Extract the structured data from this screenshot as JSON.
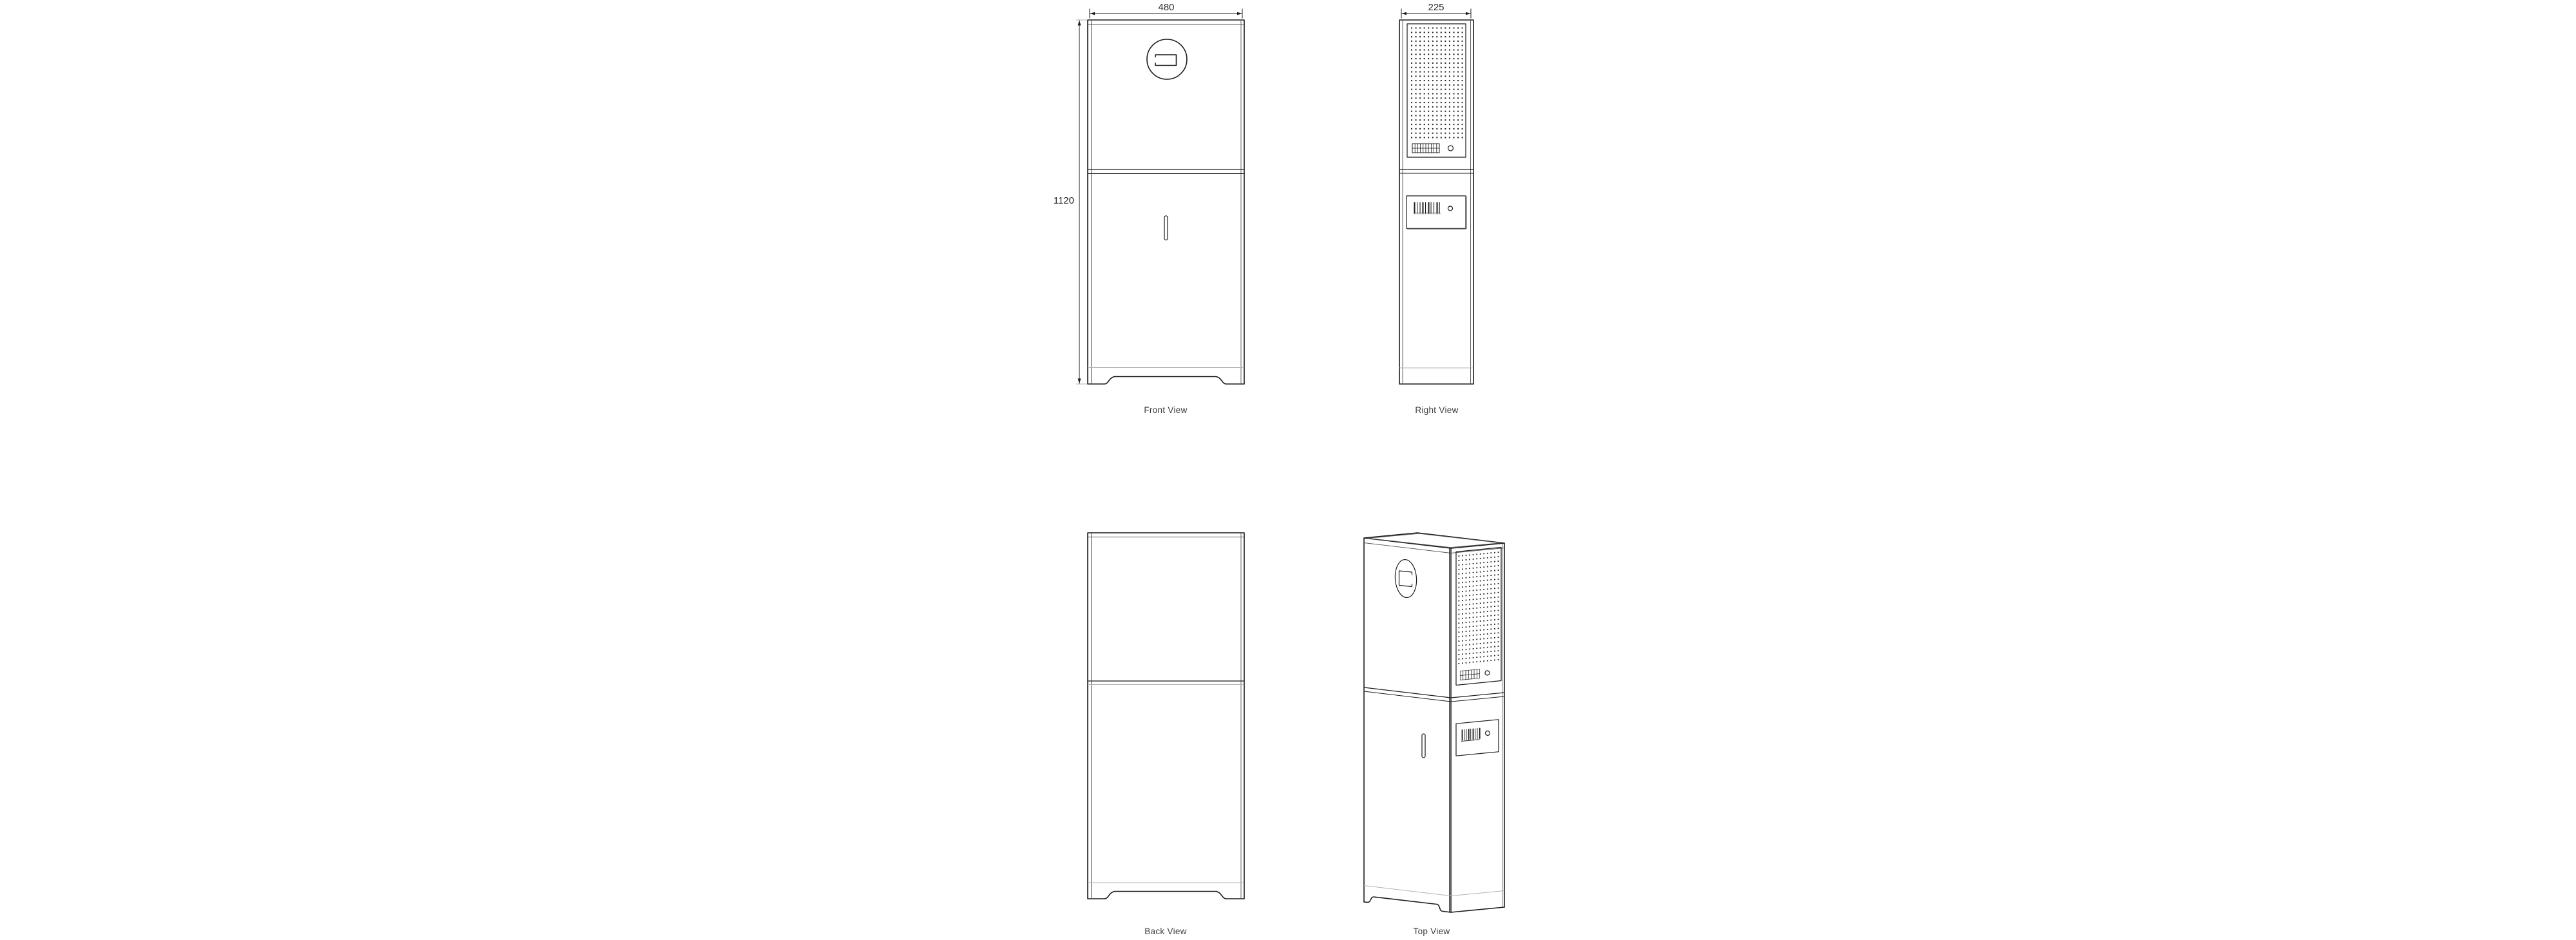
{
  "page": {
    "background": "#ffffff"
  },
  "views": {
    "front": {
      "label": "Front View",
      "width_dim": "480",
      "height_dim": "1120"
    },
    "right": {
      "label": "Right View",
      "depth_dim": "225"
    },
    "back": {
      "label": "Back View"
    },
    "top": {
      "label": "Top View"
    }
  },
  "colors": {
    "line": "#1c1c1c",
    "inner": "#555555",
    "light": "#b3b3b3",
    "dots": "#1c1c1c",
    "text": "#3d3d3d",
    "background": "#ffffff"
  }
}
